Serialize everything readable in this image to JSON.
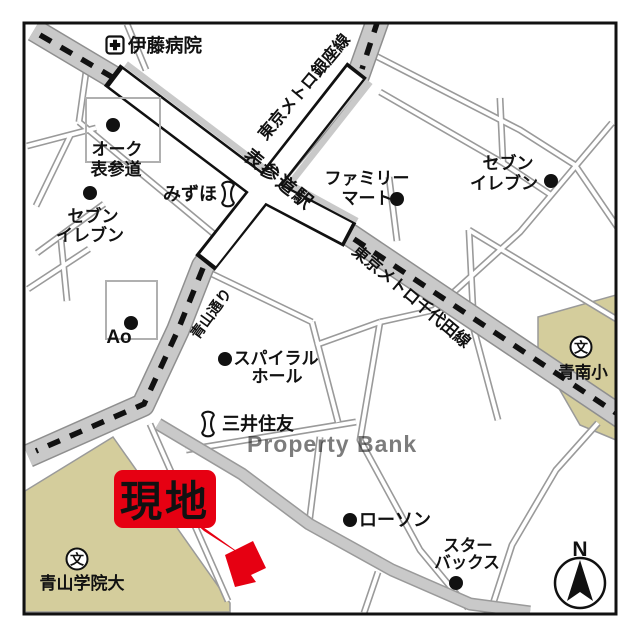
{
  "colors": {
    "accent_red": "#e60012",
    "road_gray": "#c9c9c9",
    "road_casing": "#9a9a9a",
    "school_area": "#d4cd9c",
    "text": "#111111",
    "watermark": "#cfb592"
  },
  "watermark": "Property Bank",
  "compass": {
    "north_label": "N"
  },
  "site": {
    "label": "現地"
  },
  "station": {
    "name": "表参道駅"
  },
  "transit": {
    "ginza_line": "東京メトロ銀座線",
    "chiyoda_line": "東京メトロ千代田線"
  },
  "roads": {
    "aoyama_dori": "青山通り"
  },
  "icons": {
    "school_symbol": "文"
  },
  "pois": {
    "ito_hospital": "伊藤病院",
    "oak_omotesando": {
      "line1": "オーク",
      "line2": "表参道"
    },
    "seven_eleven_west": {
      "line1": "セブン",
      "line2": "イレブン"
    },
    "mizuho": "みずほ",
    "family_mart": {
      "line1": "ファミリー",
      "line2": "マート"
    },
    "seven_eleven_east": {
      "line1": "セブン",
      "line2": "イレブン"
    },
    "ao": "Ao",
    "spiral_hall": {
      "line1": "スパイラル",
      "line2": "ホール"
    },
    "mitsui_sumitomo": "三井住友",
    "seinan_elementary": "青南小",
    "aoyama_gakuin": "青山学院大",
    "lawson": "ローソン",
    "starbucks": {
      "line1": "スター",
      "line2": "バックス"
    }
  }
}
